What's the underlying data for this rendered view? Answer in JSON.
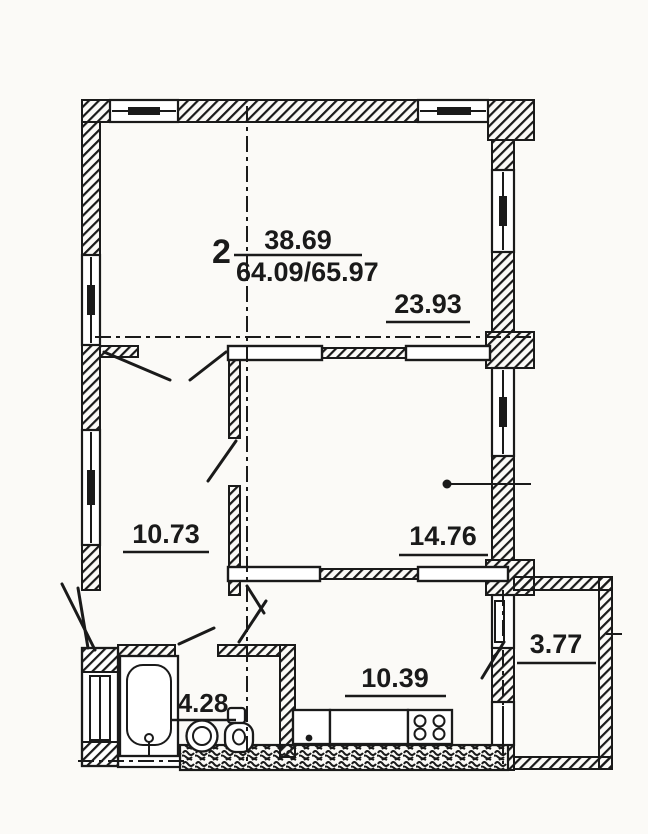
{
  "colors": {
    "ink": "#1a1a1a",
    "paper": "#fbfaf7"
  },
  "plan": {
    "apartment_number": "2",
    "living_area_total": "38.69",
    "area_ratio": "64.09/65.97",
    "rooms": {
      "living_room": "23.93",
      "bedroom": "14.76",
      "side_room": "10.73",
      "kitchen": "10.39",
      "bathroom": "4.28",
      "balcony": "3.77"
    },
    "fixtures": [
      "bathtub",
      "washbasin",
      "toilet",
      "kitchen-sink",
      "stove-4-burner",
      "ventilation-shaft"
    ]
  }
}
